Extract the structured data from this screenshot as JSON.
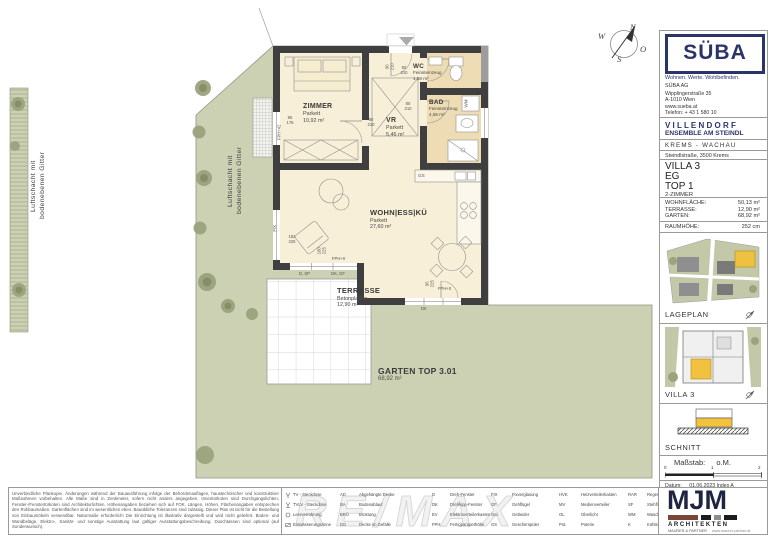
{
  "plan": {
    "rooms": {
      "zimmer": {
        "name": "ZIMMER",
        "floor": "Parkett",
        "area": "10,92 m²"
      },
      "vr": {
        "name": "VR",
        "floor": "Parkett",
        "area": "5,46 m²"
      },
      "wc": {
        "name": "WC",
        "floor": "Feinsteinzeug",
        "area": "1,59 m²"
      },
      "bad": {
        "name": "BAD",
        "floor": "Feinsteinzeug",
        "area": "4,56 m²"
      },
      "wohn": {
        "name": "WOHN|ESS|KÜ",
        "floor": "Parkett",
        "area": "27,60 m²"
      },
      "terrasse": {
        "name": "TERRASSE",
        "floor": "Betonplatten",
        "area": "12,90 m²"
      },
      "garten": {
        "name": "GARTEN TOP 3.01",
        "area": "68,92 m²"
      }
    },
    "shaft_note_line1": "Luftschacht mit",
    "shaft_note_line2": "bodenebenen Gitter",
    "dims": {
      "entry": "90 210",
      "wc_door": "80 210",
      "bad_door": "80 210",
      "zimmer_door": "80 210",
      "zimmer_window": "95 176",
      "zimmer_window_h": "FPH+42",
      "fix": "FIX",
      "liv_window1": "182 225",
      "liv_window2": "180 225",
      "liv_h": "FPH+0",
      "glz1": "D, SP",
      "glz2": "DK, GF",
      "garden_door": "95 225",
      "garden_door_h": "FPH+0",
      "garden_glz": "DK",
      "gs": "GS",
      "wm": "WM"
    },
    "compass": {
      "n": "N",
      "e": "O",
      "s": "S",
      "w": "W"
    }
  },
  "titleblock": {
    "brand": {
      "logo": "SÜBA",
      "tagline": "Wohnen. Werte. Wohlbefinden.",
      "company": "SÜBA AG",
      "address1": "Wipplingerstraße 35",
      "address2": "A-1010 Wien",
      "web": "www.sueba.at",
      "phone": "Telefon: + 43 1 580 10"
    },
    "project": {
      "name": "V I L L E N D O R F",
      "subtitle": "ENSEMBLE AM STEINDL",
      "region": "KREMS - WACHAU",
      "street": "Steindlstraße, 3500 Krems"
    },
    "unit": {
      "villa": "VILLA 3",
      "floor": "EG",
      "top": "TOP 1",
      "type": "2-ZIMMER"
    },
    "areas": [
      {
        "label": "WOHNFLÄCHE:",
        "value": "50,13 m²"
      },
      {
        "label": "TERRASSE:",
        "value": "12,90 m²"
      },
      {
        "label": "GARTEN:",
        "value": "68,92 m²"
      }
    ],
    "height": {
      "label": "RAUMHÖHE:",
      "value": "252 cm"
    },
    "thumbs": {
      "lageplan": "LAGEPLAN",
      "villa": "VILLA 3",
      "schnitt": "SCHNITT"
    },
    "scale": {
      "label": "Maßstab:",
      "value": "o.M.",
      "tick0": "0",
      "tick1": "1",
      "tick2": "2"
    },
    "date": {
      "label": "Datum:",
      "value": "01.06.2023 Index A"
    },
    "architect": {
      "logo": "MJM",
      "line1": "ARCHITEKTEN",
      "line2": "MAURER & PARTNER",
      "web": "www.maurer-partner.at"
    }
  },
  "legend": {
    "symbol_items": [
      "TV - Steckdose",
      "TVLV - Steckdose",
      "Leerverrohrung",
      "Entwässerungsrinne"
    ],
    "groups": [
      {
        "items": [
          [
            "AD",
            "Abgehängte Decke"
          ],
          [
            "BA",
            "Bodenablauf"
          ],
          [
            "BRÜ",
            "Brüstung"
          ],
          [
            "DG",
            "Decke im Gefälle"
          ]
        ]
      },
      {
        "items": [
          [
            "D",
            "Dreh-Fenster"
          ],
          [
            "DK",
            "Drehkipp-Fenster"
          ],
          [
            "EV",
            "Elektroverteilerkasten"
          ],
          [
            "FPH",
            "Fertigparapethöhe"
          ]
        ]
      },
      {
        "items": [
          [
            "FIX",
            "Fixverglasung"
          ],
          [
            "GF",
            "Gehflügel"
          ],
          [
            "Gel.",
            "Geländer"
          ],
          [
            "GS",
            "Geschirrspüler"
          ]
        ]
      },
      {
        "items": [
          [
            "HVK",
            "Heizverteilerkasten"
          ],
          [
            "MV",
            "Medienverteiler"
          ],
          [
            "OL",
            "Oberlicht"
          ],
          [
            "Pot.",
            "Poterie"
          ]
        ]
      },
      {
        "items": [
          [
            "RAR",
            "Regenrohr"
          ],
          [
            "SF",
            "Stehflügel"
          ],
          [
            "WM",
            "Waschmaschine"
          ],
          [
            "K",
            "Kühlschrank"
          ]
        ]
      }
    ]
  },
  "disclaimer": "Unverbindliche Plankopie. Änderungen während der Bauausführung infolge der Behördenauflagen, haustechnischer und konstruktiver Maßnahmen vorbehalten. Alle Maße sind in Zentimeter, sofern nicht anders angegeben. Innentürkoten sind Durchgangslichten, Fenster-/Fenstertürkoten sind Architekturlichten. Höhenangaben beziehen sich auf FOK. Längen, Höhen, Flächenangaben entsprechen den Rohbaumaßen. Gartenflächen sind im wesentlichen eben. Bauübliche Toleranzen sind zulässig. Dieser Plan ist nicht für die Bestellung von Einbaumöbeln verwendbar. Naturmaße erforderlich! Die Einrichtung ist illustrativ dargestellt und wird nicht geliefert. Boden- und Wandbeläge, Elektro-, Sanitär- und sonstige Ausstattung laut gültiger Ausstattungsbeschreibung. Duschtassen sind optional (auf Sonderwunsch).",
  "watermark": "RE/MAX"
}
